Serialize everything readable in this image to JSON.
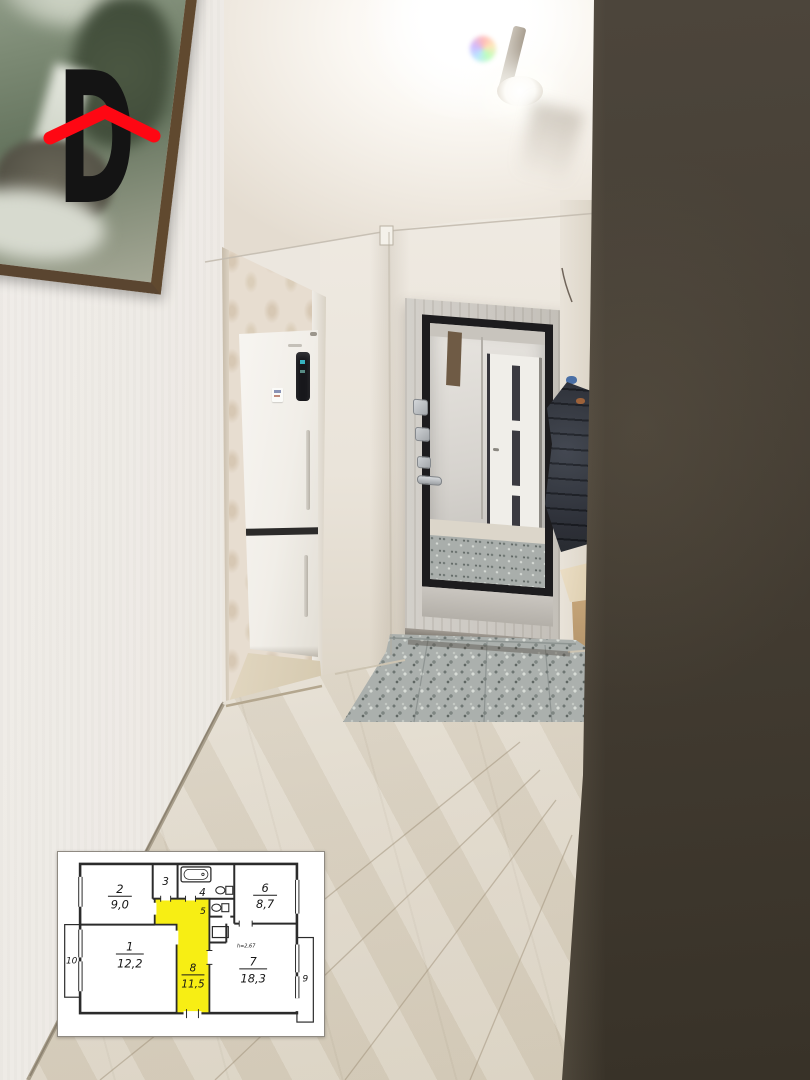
{
  "watermark": {
    "letter": "D",
    "roof_color": "#fe0713",
    "letter_color": "#141414"
  },
  "floorplan": {
    "highlight_color": "#f7ee14",
    "ceiling_height_note": "h=2,67",
    "room1": {
      "number": "1",
      "area": "12,2"
    },
    "room2": {
      "number": "2",
      "area": "9,0"
    },
    "room3": {
      "number": "3"
    },
    "room4": {
      "number": "4"
    },
    "room5": {
      "number": "5"
    },
    "room6": {
      "number": "6",
      "area": "8,7"
    },
    "room7": {
      "number": "7",
      "area": "18,3"
    },
    "room8": {
      "number": "8",
      "area": "11,5"
    },
    "room9": {
      "number": "9"
    },
    "room10": {
      "number": "10"
    }
  }
}
